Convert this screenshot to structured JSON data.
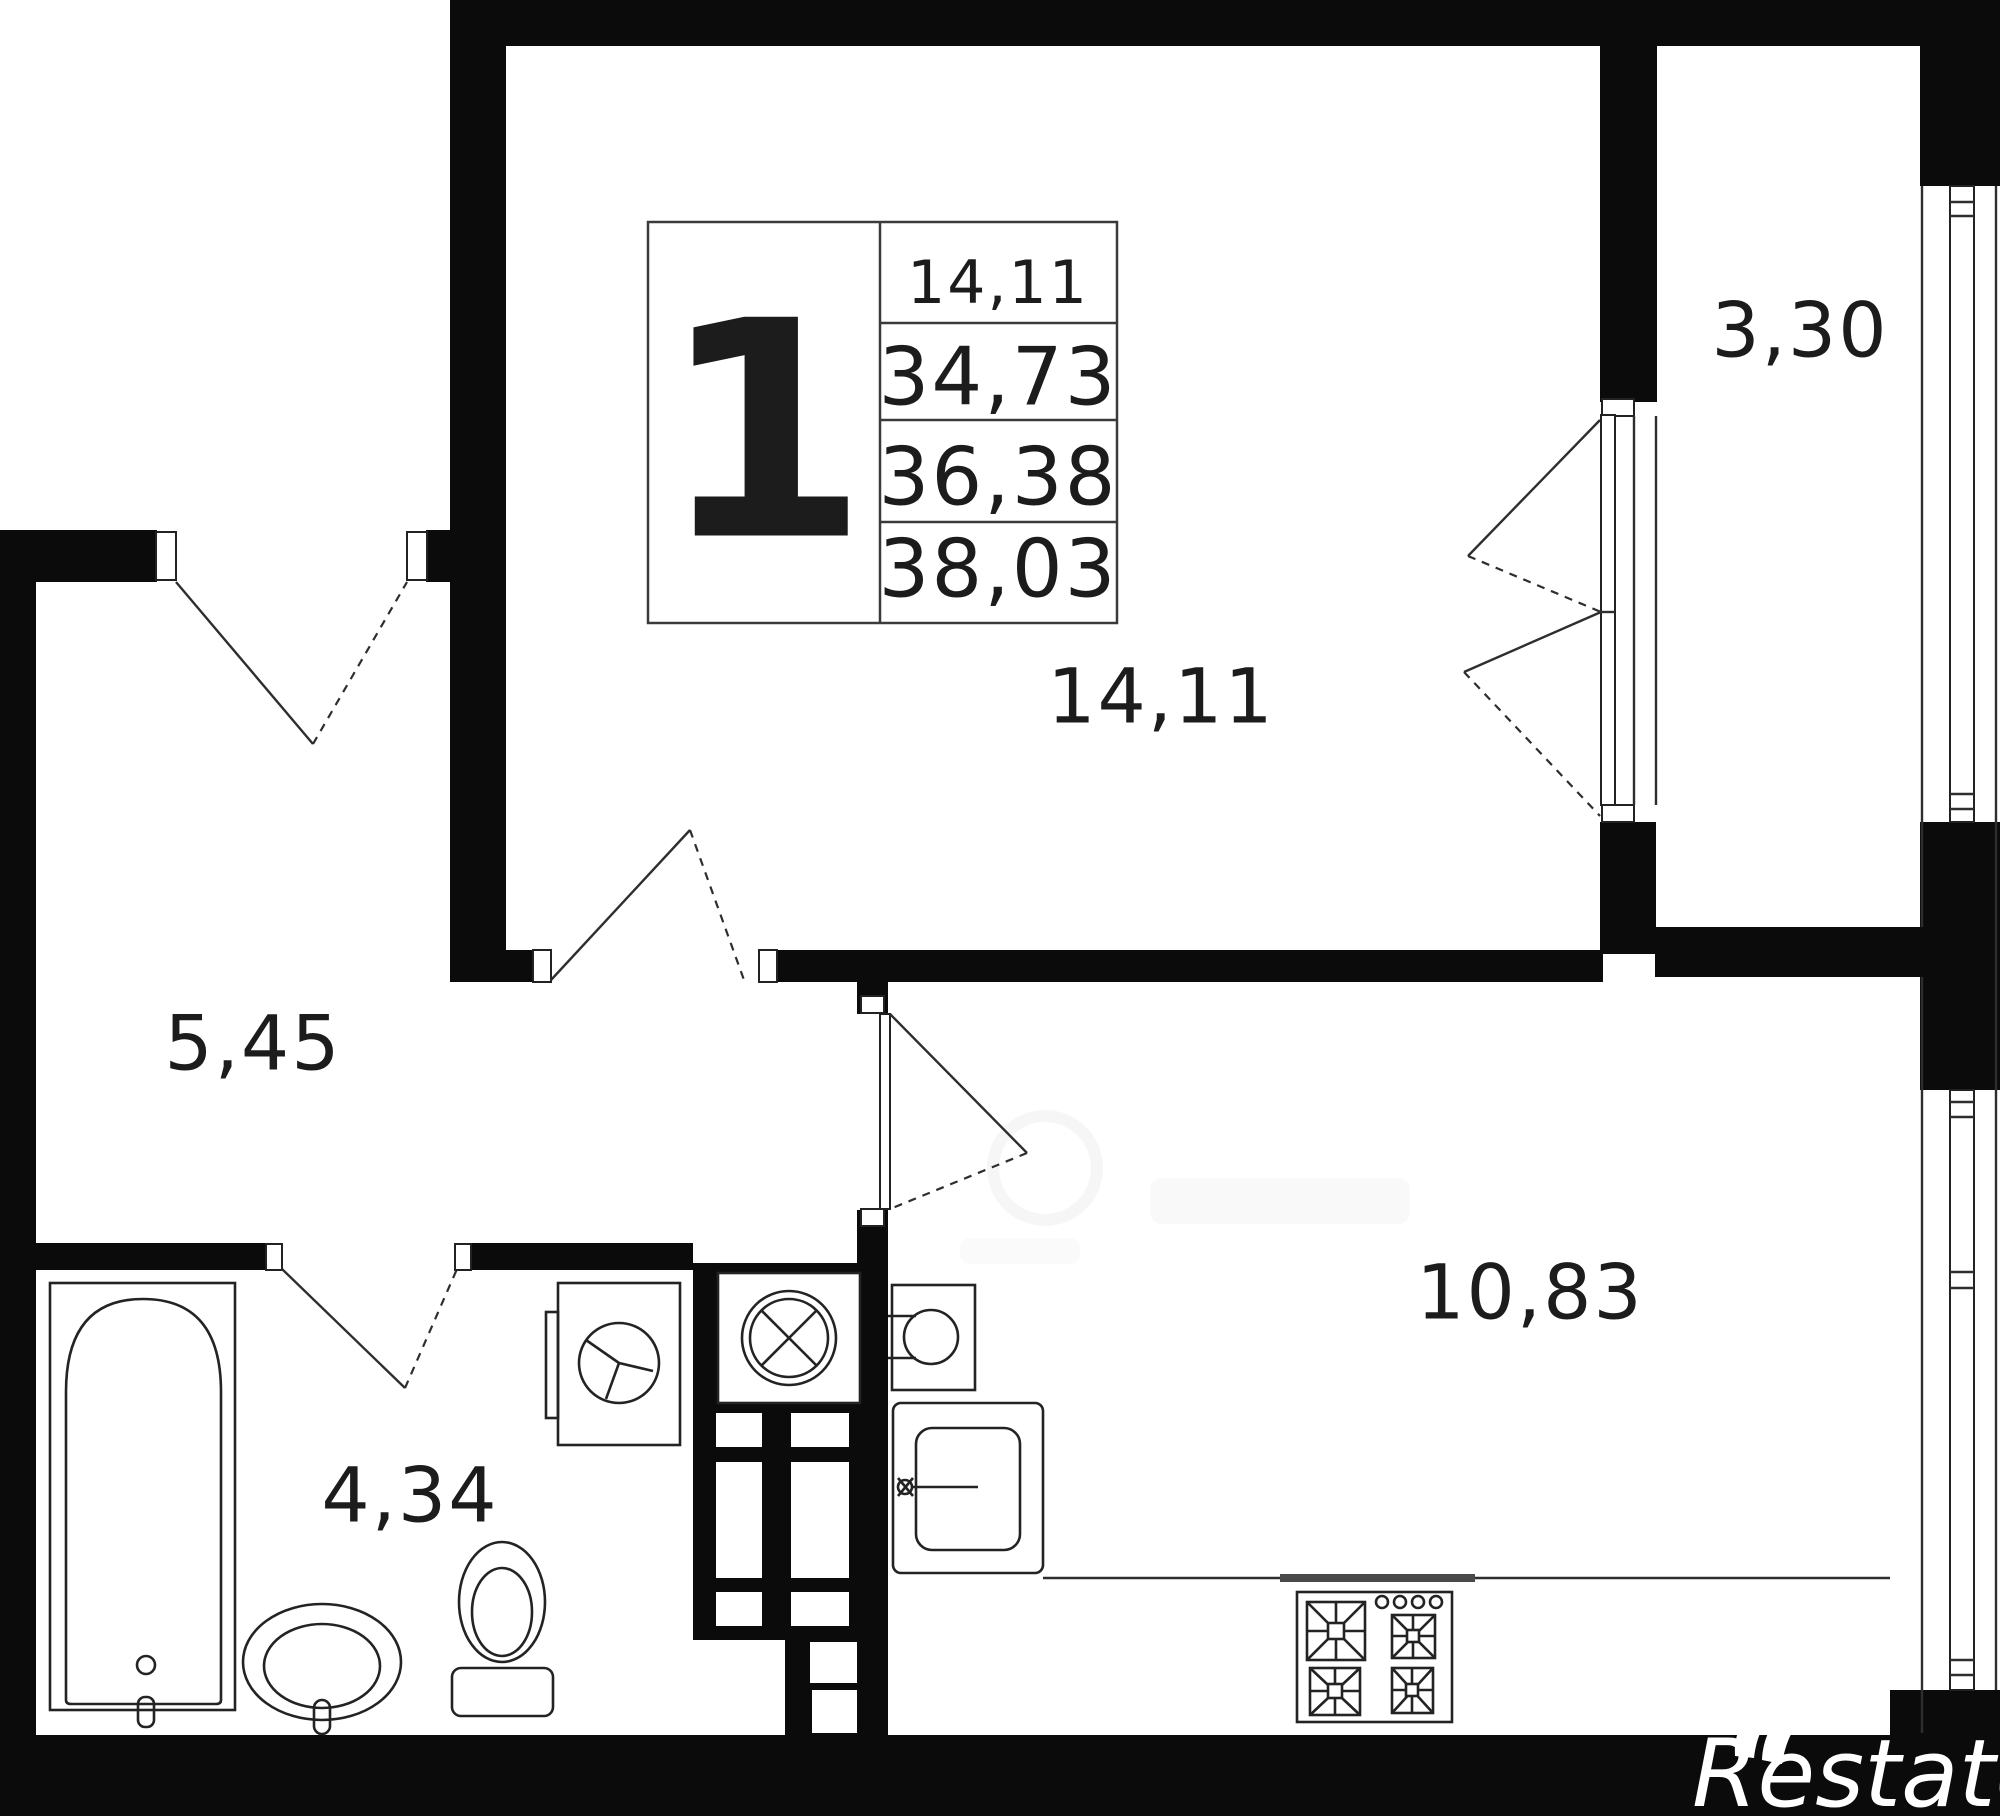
{
  "unit": {
    "number": "1",
    "areas": [
      "14,11",
      "34,73",
      "36,38",
      "38,03"
    ]
  },
  "rooms": {
    "living": "14,11",
    "balcony": "3,30",
    "hallway": "5,45",
    "bathroom": "4,34",
    "kitchen": "10,83"
  },
  "brand": {
    "text": "Restate"
  },
  "icons": {
    "fixtures": [
      "bathtub-icon",
      "washbasin-icon",
      "toilet-icon",
      "washing-machine-icon",
      "ventilation-fan-icon",
      "boiler-icon",
      "kitchen-sink-icon",
      "stove-icon"
    ]
  },
  "colors": {
    "wall": "#0b0b0b",
    "line": "#2e2e2e",
    "background": "#ffffff",
    "watermark_text": "#ffffff"
  }
}
